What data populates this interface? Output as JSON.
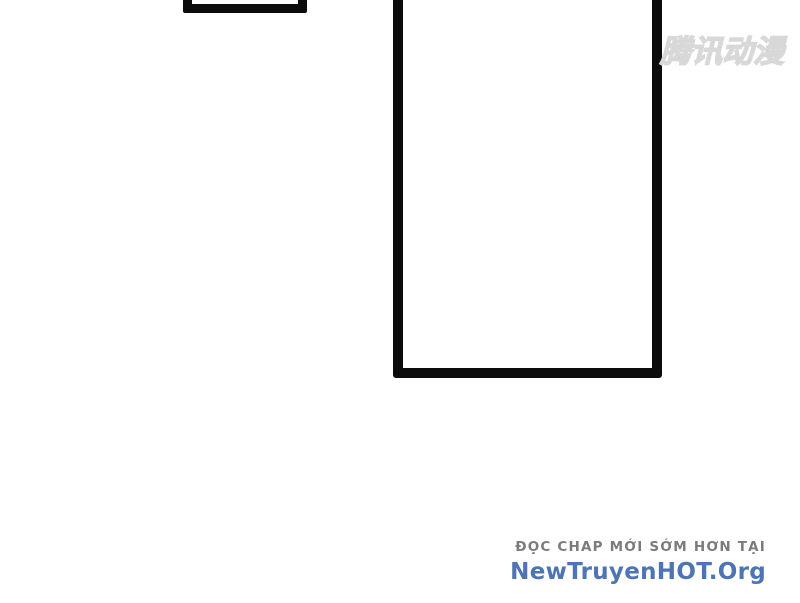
{
  "page": {
    "background_color": "#ffffff",
    "panel_border_color": "#0c0c0c"
  },
  "panels": {
    "small_top_left": {
      "description": "empty comic panel cut off by top edge"
    },
    "large_center": {
      "description": "empty comic panel cut off by top edge"
    }
  },
  "watermark": {
    "text": "腾讯动漫",
    "color": "#d8d8d8"
  },
  "footer": {
    "tagline": "ĐỌC CHAP MỚI SỚM HƠN TẠI",
    "tagline_color": "#7b7b7b",
    "site": "NewTruyenHOT.Org",
    "site_color": "#4e74b4"
  }
}
